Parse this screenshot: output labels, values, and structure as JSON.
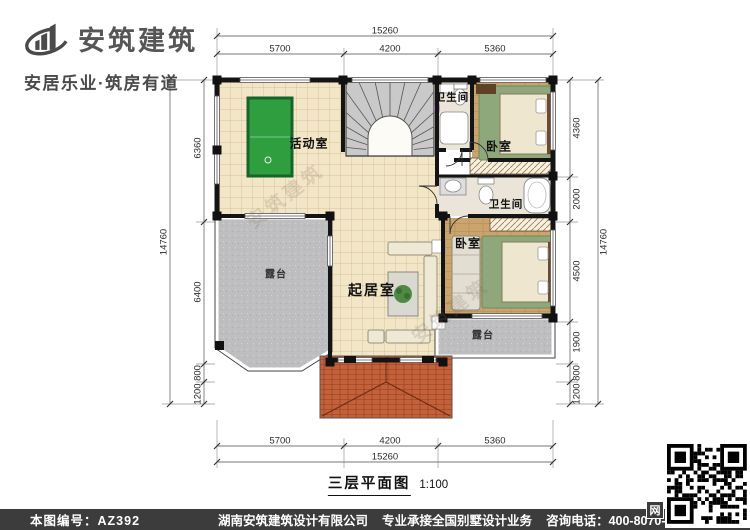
{
  "brand": {
    "name": "安筑建筑",
    "tagline": "安居乐业·筑房有道"
  },
  "plan": {
    "caption": "三层平面图",
    "scale": "1:100",
    "watermark": "安筑建筑",
    "rooms": {
      "activity": "活动室",
      "bath_top": "卫生间",
      "bedroom_top": "卧室",
      "bath_mid": "卫生间",
      "bedroom_mid": "卧室",
      "living": "起居室",
      "terrace_left": "露台",
      "terrace_right": "露台"
    },
    "dims": {
      "top_total": "15260",
      "top_segments": [
        "5700",
        "4200",
        "5360"
      ],
      "bottom_segments": [
        "5700",
        "4200",
        "5360"
      ],
      "bottom_total": "15260",
      "left_total": "14760",
      "left_segments": [
        "6360",
        "6400",
        "800",
        "1200"
      ],
      "right_segments": [
        "4360",
        "2000",
        "4500",
        "1900",
        "800",
        "1200"
      ],
      "right_total": "14760"
    }
  },
  "footer": {
    "plan_number": "本图编号：AZ392",
    "company": "湖南安筑建筑设计有限公司",
    "service": "专业承接全国别墅设计业务",
    "phone": "咨询电话：400-8070-511",
    "web_badge": "网"
  },
  "colors": {
    "wall": "#141414",
    "floor_tile": "#f3e6c6",
    "wood": "#cba36c",
    "terrace": "#bebec0",
    "roof": "#c4613a",
    "pool_table": "#2f9e3e",
    "footer_bg": "#3c3c3c"
  }
}
